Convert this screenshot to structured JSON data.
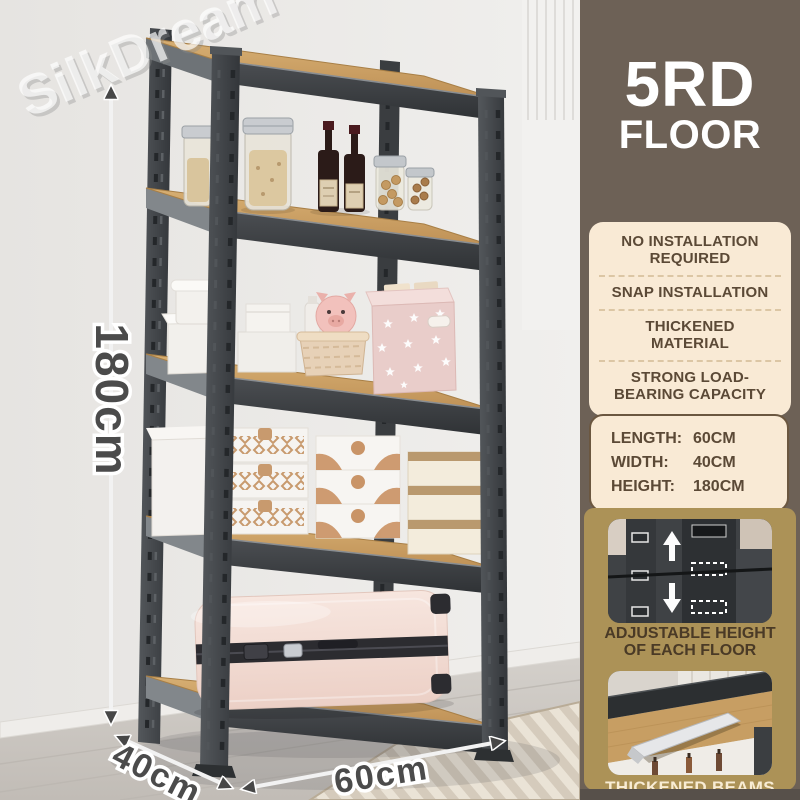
{
  "watermark": {
    "text": "SilkDream"
  },
  "photo": {
    "dimensions": {
      "height": "180cm",
      "depth": "40cm",
      "width": "60cm"
    }
  },
  "panel": {
    "header": {
      "line1": "5RD",
      "line2": "FLOOR"
    },
    "features": [
      "NO INSTALLATION REQUIRED",
      "SNAP INSTALLATION",
      "THICKENED MATERIAL",
      "STRONG LOAD-BEARING CAPACITY"
    ],
    "specs": [
      {
        "label": "LENGTH:",
        "value": "60CM"
      },
      {
        "label": "WIDTH:",
        "value": "40CM"
      },
      {
        "label": "HEIGHT:",
        "value": "180CM"
      }
    ],
    "cards": [
      {
        "caption_line1": "ADJUSTABLE HEIGHT",
        "caption_line2": "OF EACH FLOOR"
      },
      {
        "caption": "THICKENED BEAMS"
      }
    ]
  },
  "colors": {
    "panel-brown": "#6d6156",
    "panel-brown-dark": "#57504a",
    "cream": "#f9ead5",
    "gold": "#ac9257",
    "text-brown": "#5b4936",
    "caption-cream": "#f8ecd4",
    "metal-dark": "#3a3d40",
    "wood": "#c9a164",
    "suitcase-pink": "#f3ddd4",
    "cube-pink": "#e9cdca"
  }
}
